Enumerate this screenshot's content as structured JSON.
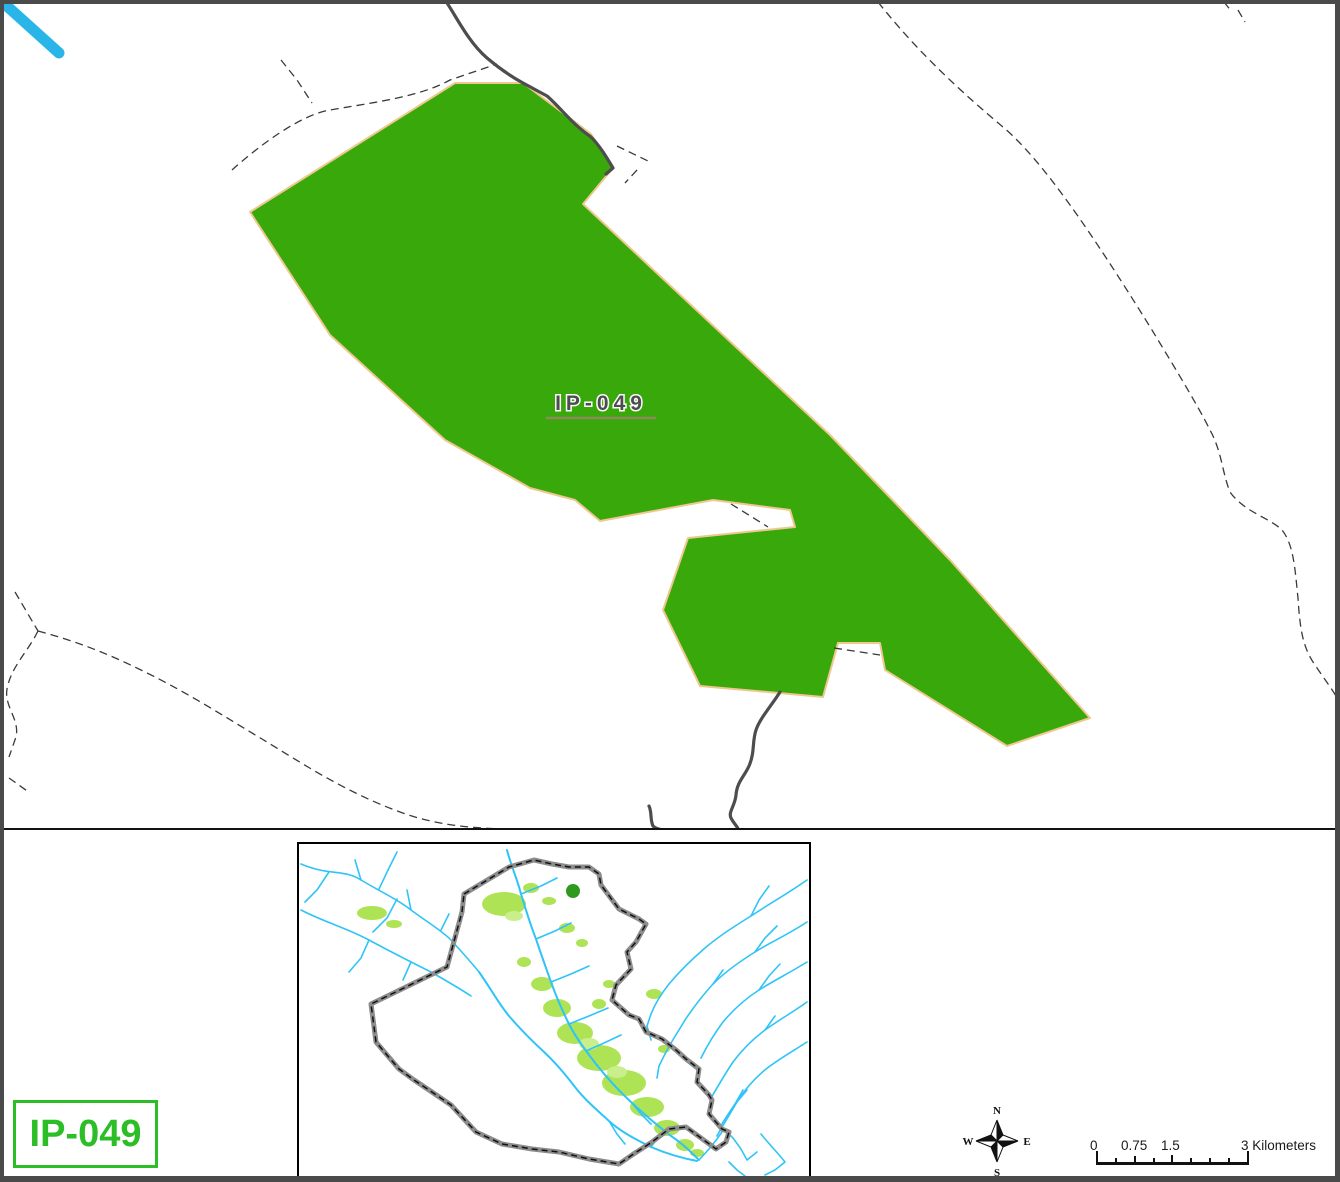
{
  "map_sheet": {
    "type": "GIS map export",
    "background": "#FFFFFF",
    "frame_color": "#4A4A4A"
  },
  "main_map": {
    "parcel": {
      "label": "IP-049",
      "fill_color": "#38A80A",
      "outline_color": "#EEC88F",
      "label_color": "#4D4D4D"
    },
    "road_color": "#4D4D4D",
    "boundary_dash_color": "#3A3A3A",
    "river_color": "#29B5E8"
  },
  "legend": {
    "label": "IP-049",
    "color": "#2CBE26"
  },
  "inset": {
    "country": "country outline",
    "border_color": "#000000",
    "country_outline_color": "#8C8C8C",
    "river_color": "#2FC4F7",
    "vegetation_color": "#AEE356",
    "site_marker_color": "#2E991C"
  },
  "compass": {
    "n": "N",
    "s": "S",
    "e": "E",
    "w": "W"
  },
  "scale_bar": {
    "labels": [
      "0",
      "0.75",
      "1.5"
    ],
    "end_label": "3 Kilometers"
  }
}
